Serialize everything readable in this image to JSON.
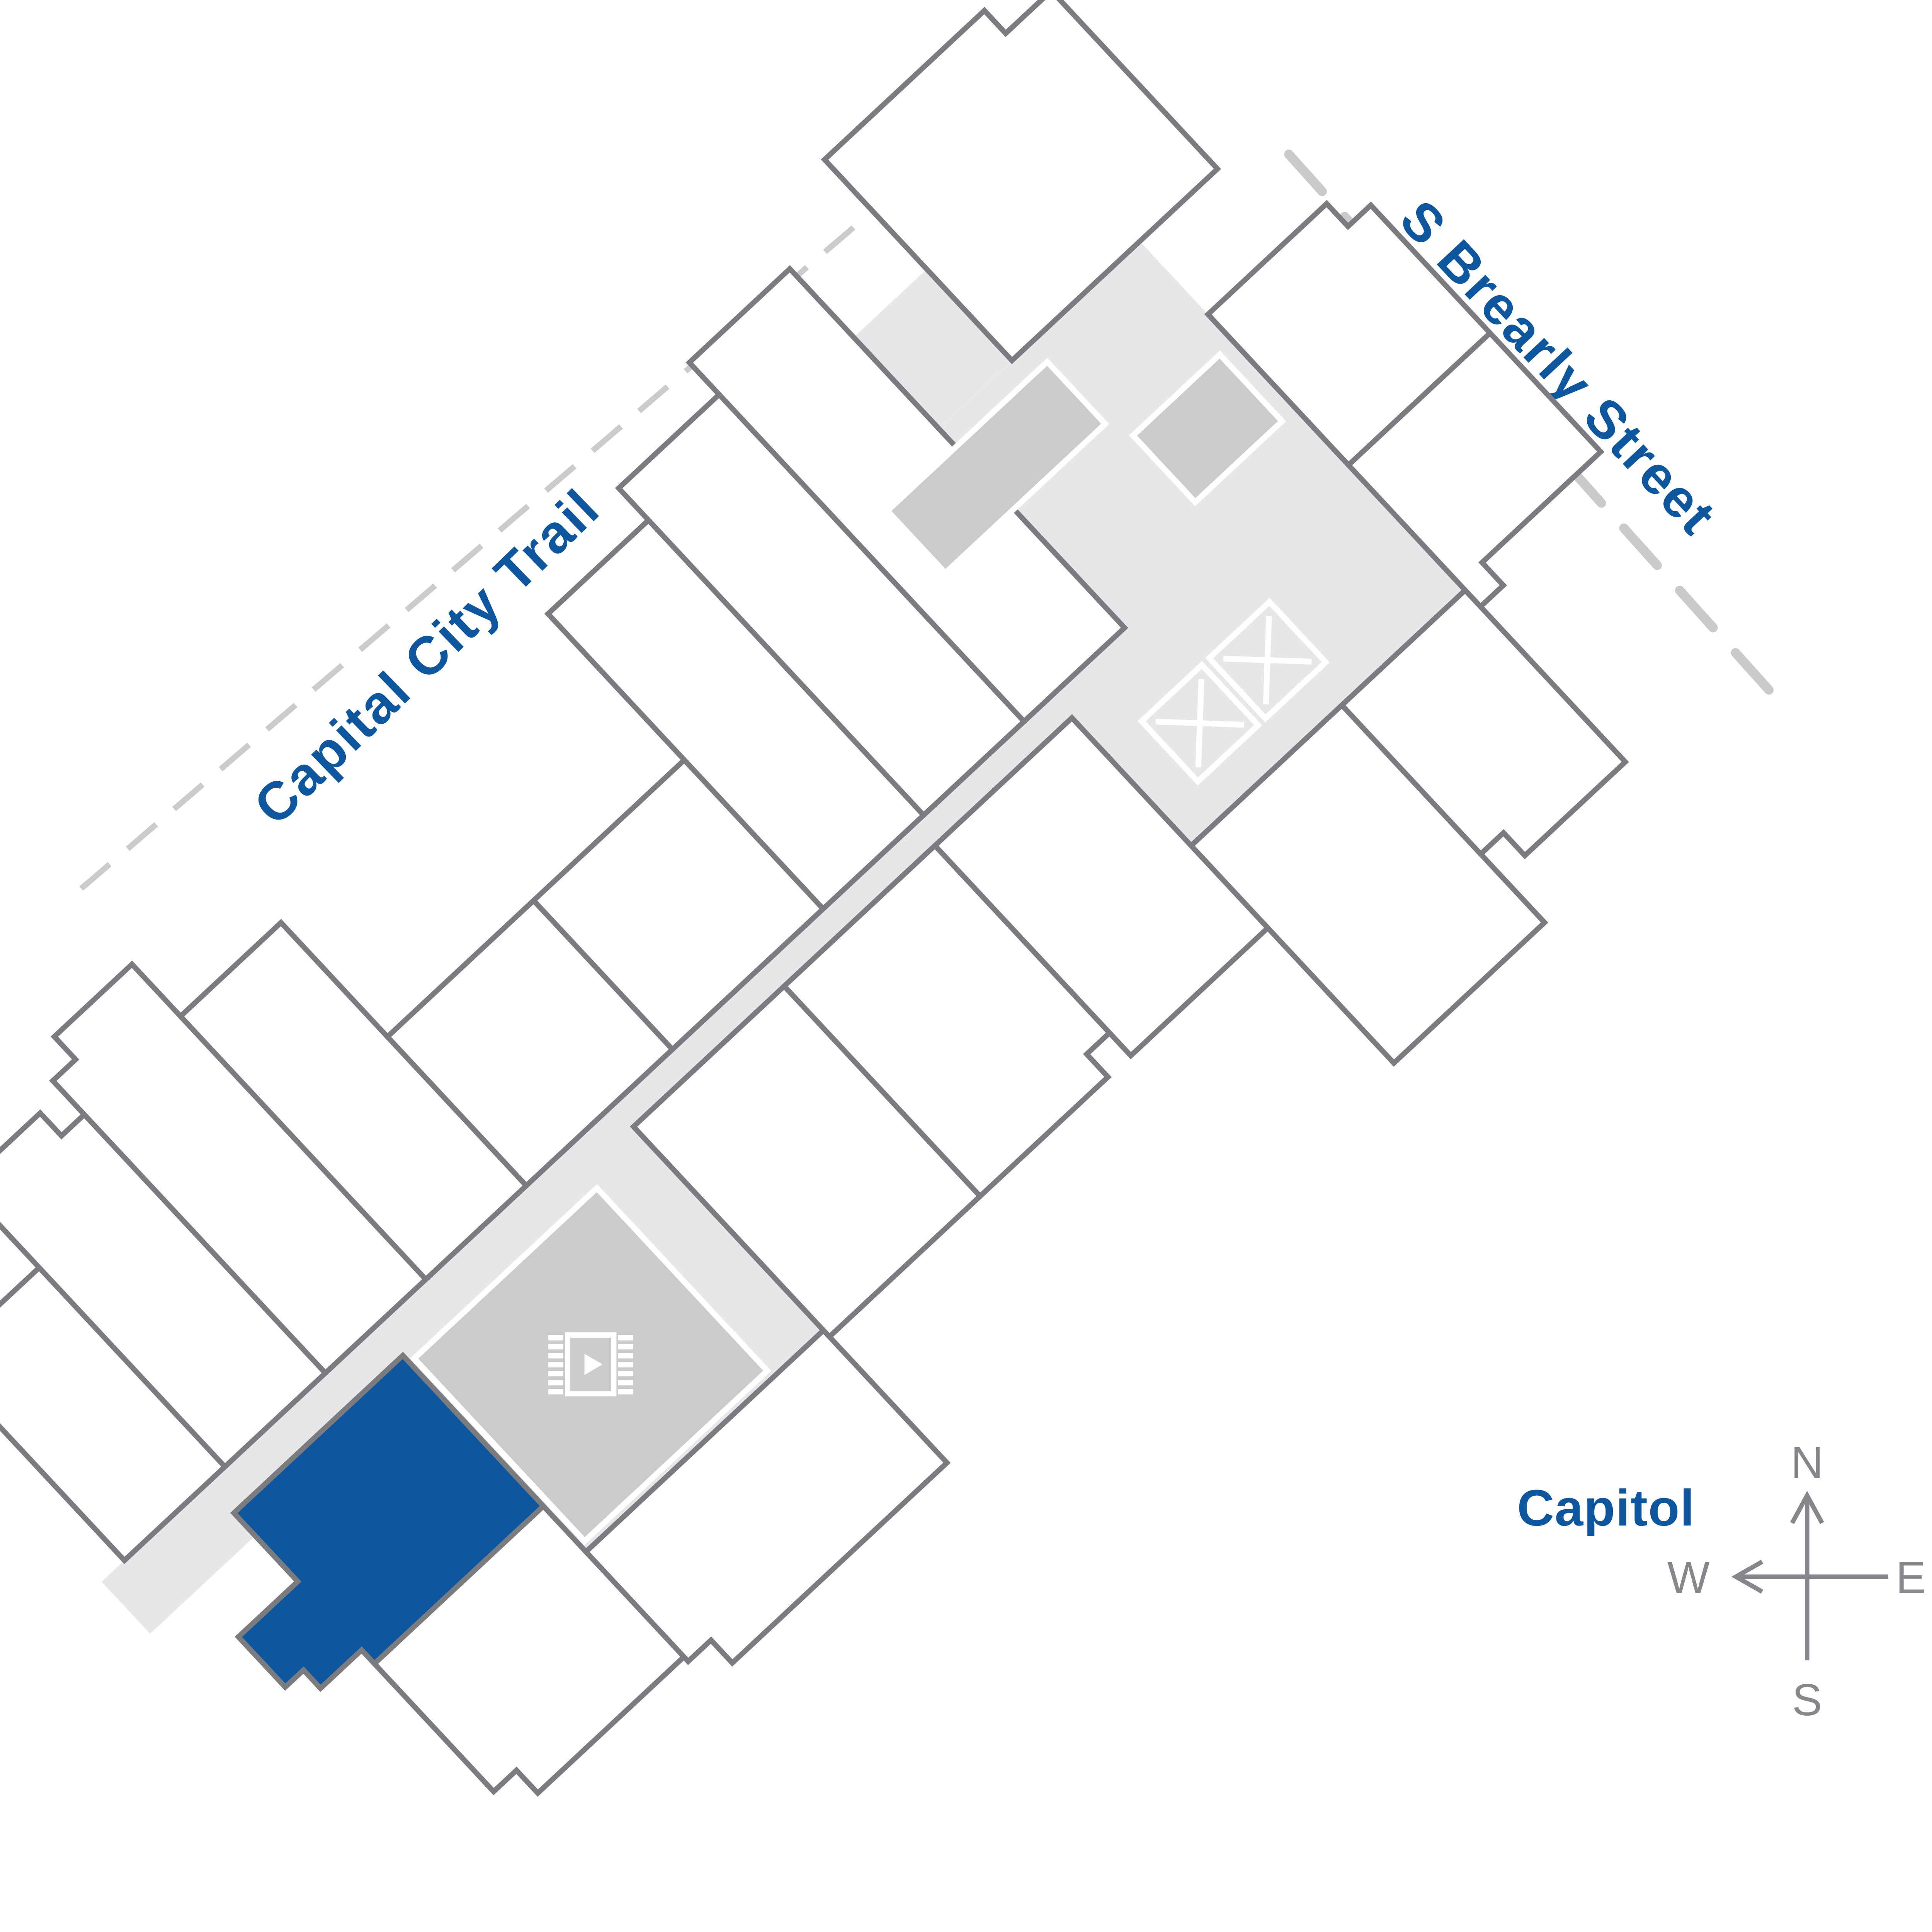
{
  "labels": {
    "trail": "Capital City Trail",
    "street": "S Brearly Street",
    "landmark": "Capitol"
  },
  "compass": {
    "north": "N",
    "south": "S",
    "east": "E",
    "west": "W"
  },
  "icons": {
    "media_room": "film-media-icon",
    "elevators": "elevator-x-icon",
    "elevator_count": 2,
    "compass": "compass-rose"
  },
  "colors": {
    "accent_blue": "#0e579f",
    "floor_gray": "#e6e7e8",
    "block_gray": "#c9cbcd",
    "outline_gray": "#7a7c7f",
    "compass_gray": "#85878a",
    "dash_gray": "#cacbcd"
  },
  "highlighted_unit": {
    "status": "selected",
    "color": "#0e579f"
  }
}
